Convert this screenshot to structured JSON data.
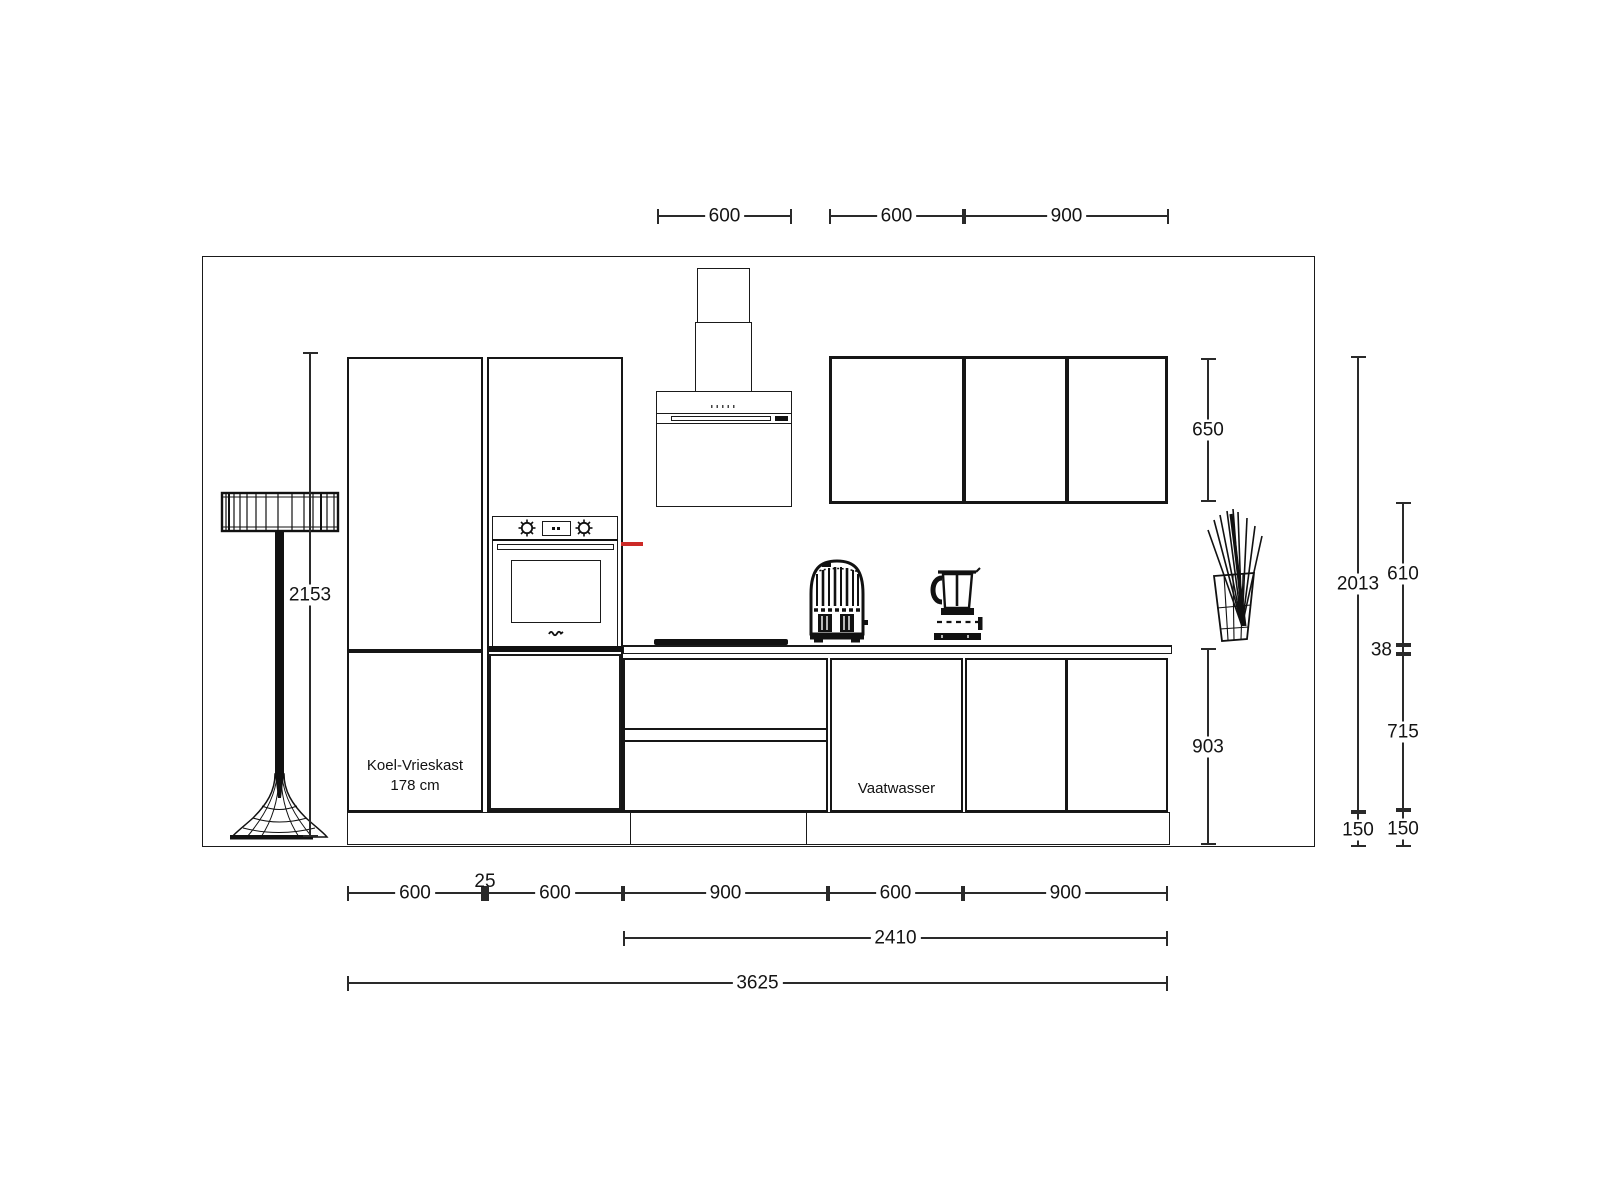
{
  "drawing": {
    "title": "kitchen-elevation",
    "labels": {
      "fridge_line1": "Koel-Vrieskast",
      "fridge_line2": "178 cm",
      "dishwasher": "Vaatwasser"
    },
    "dims": {
      "top_hood": "600",
      "top_upper_single": "600",
      "top_upper_double": "900",
      "lamp_height": "2153",
      "upper_cabinet_height": "650",
      "wall_section_total": "2013",
      "backsplash_height": "610",
      "worktop_thickness": "38",
      "base_front_height": "715",
      "plinth_left": "150",
      "plinth_right": "150",
      "base_total_height": "903",
      "bottom_fridge": "600",
      "bottom_gap": "25",
      "bottom_oven": "600",
      "bottom_drawers": "900",
      "bottom_dishwasher": "600",
      "bottom_sink": "900",
      "run_right": "2410",
      "run_total": "3625"
    },
    "colors": {
      "line": "#1a1a1a",
      "accent_red": "#cc2a27",
      "background": "#ffffff"
    }
  }
}
